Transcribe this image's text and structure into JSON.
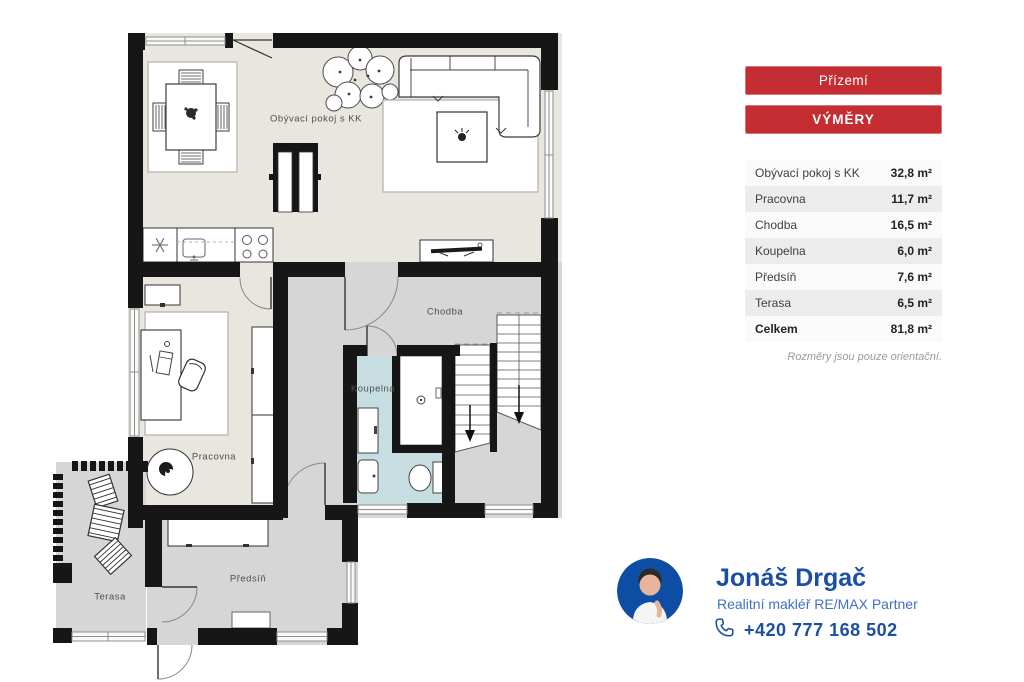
{
  "plan": {
    "rooms": {
      "living": {
        "label": "Obývací pokoj s KK"
      },
      "chodba": {
        "label": "Chodba"
      },
      "koupelna": {
        "label": "Koupelna"
      },
      "pracovna": {
        "label": "Pracovna"
      },
      "predsin": {
        "label": "Předsíň"
      },
      "terasa": {
        "label": "Terasa"
      }
    }
  },
  "panel": {
    "floor_button": "Přízemí",
    "areas_button": "VÝMĚRY",
    "table": {
      "rows": [
        {
          "label": "Obývací pokoj s KK",
          "area": "32,8 m²"
        },
        {
          "label": "Pracovna",
          "area": "11,7 m²"
        },
        {
          "label": "Chodba",
          "area": "16,5 m²"
        },
        {
          "label": "Koupelna",
          "area": "6,0 m²"
        },
        {
          "label": "Předsíň",
          "area": "7,6 m²"
        },
        {
          "label": "Terasa",
          "area": "6,5 m²"
        }
      ],
      "total": {
        "label": "Celkem",
        "area": "81,8 m²"
      }
    },
    "note": "Rozměry jsou pouze orientační."
  },
  "agent": {
    "name": "Jonáš Drgač",
    "role": "Realitní makléř RE/MAX Partner",
    "phone": "+420 777 168 502"
  },
  "colors": {
    "accent_red": "#c42d32",
    "brand_blue": "#1c4fa3",
    "wall_black": "#161616",
    "floor_beige": "#e9e5df",
    "floor_gray": "#d6d6d6",
    "floor_bath": "#c6dde2"
  }
}
